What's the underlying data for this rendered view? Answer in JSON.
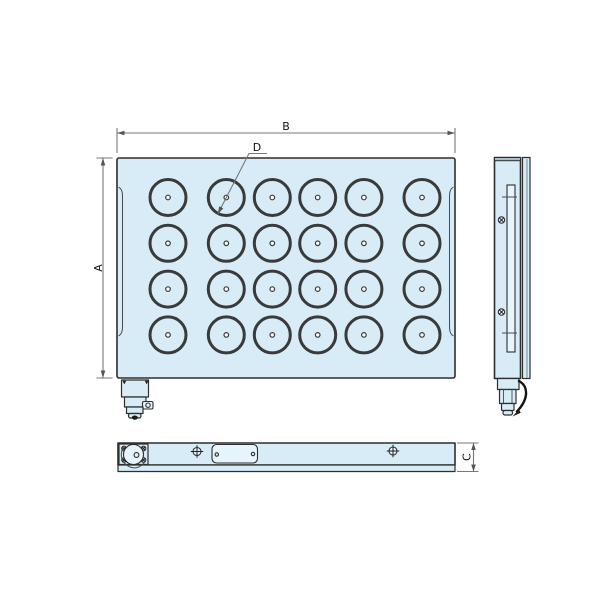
{
  "drawing_type": "orthographic technical drawing of a permanent magnetic chuck with round poles",
  "colors": {
    "background": "#ffffff",
    "body_fill": "#d8ecf7",
    "feature_fill": "#e6f4fb",
    "outline": "#2e2e2e",
    "pole_ring": "#3a3a3a",
    "dimension_line": "#777777",
    "top_cap": "#a9bdc7",
    "label_text": "#111111"
  },
  "dimensions": {
    "height_label": "A",
    "width_label": "B",
    "thickness_label": "C",
    "pole_diameter_label": "D"
  },
  "front_view": {
    "pole_grid": {
      "rows": 4,
      "cols": 6,
      "pole_count": 24,
      "col_centers_x": [
        168,
        226.3,
        272.3,
        317.7,
        363.9,
        422
      ],
      "row_centers_y": [
        197.5,
        243.3,
        289.1,
        334.9
      ],
      "outer_radius": 18,
      "ring_stroke": 3,
      "center_dot_radius": 2.3
    }
  },
  "side_view": {
    "screw_count": 2
  },
  "bottom_view": {
    "corner_screw_count": 4,
    "position_marker_count": 2,
    "nameplate_screw_count": 2
  }
}
